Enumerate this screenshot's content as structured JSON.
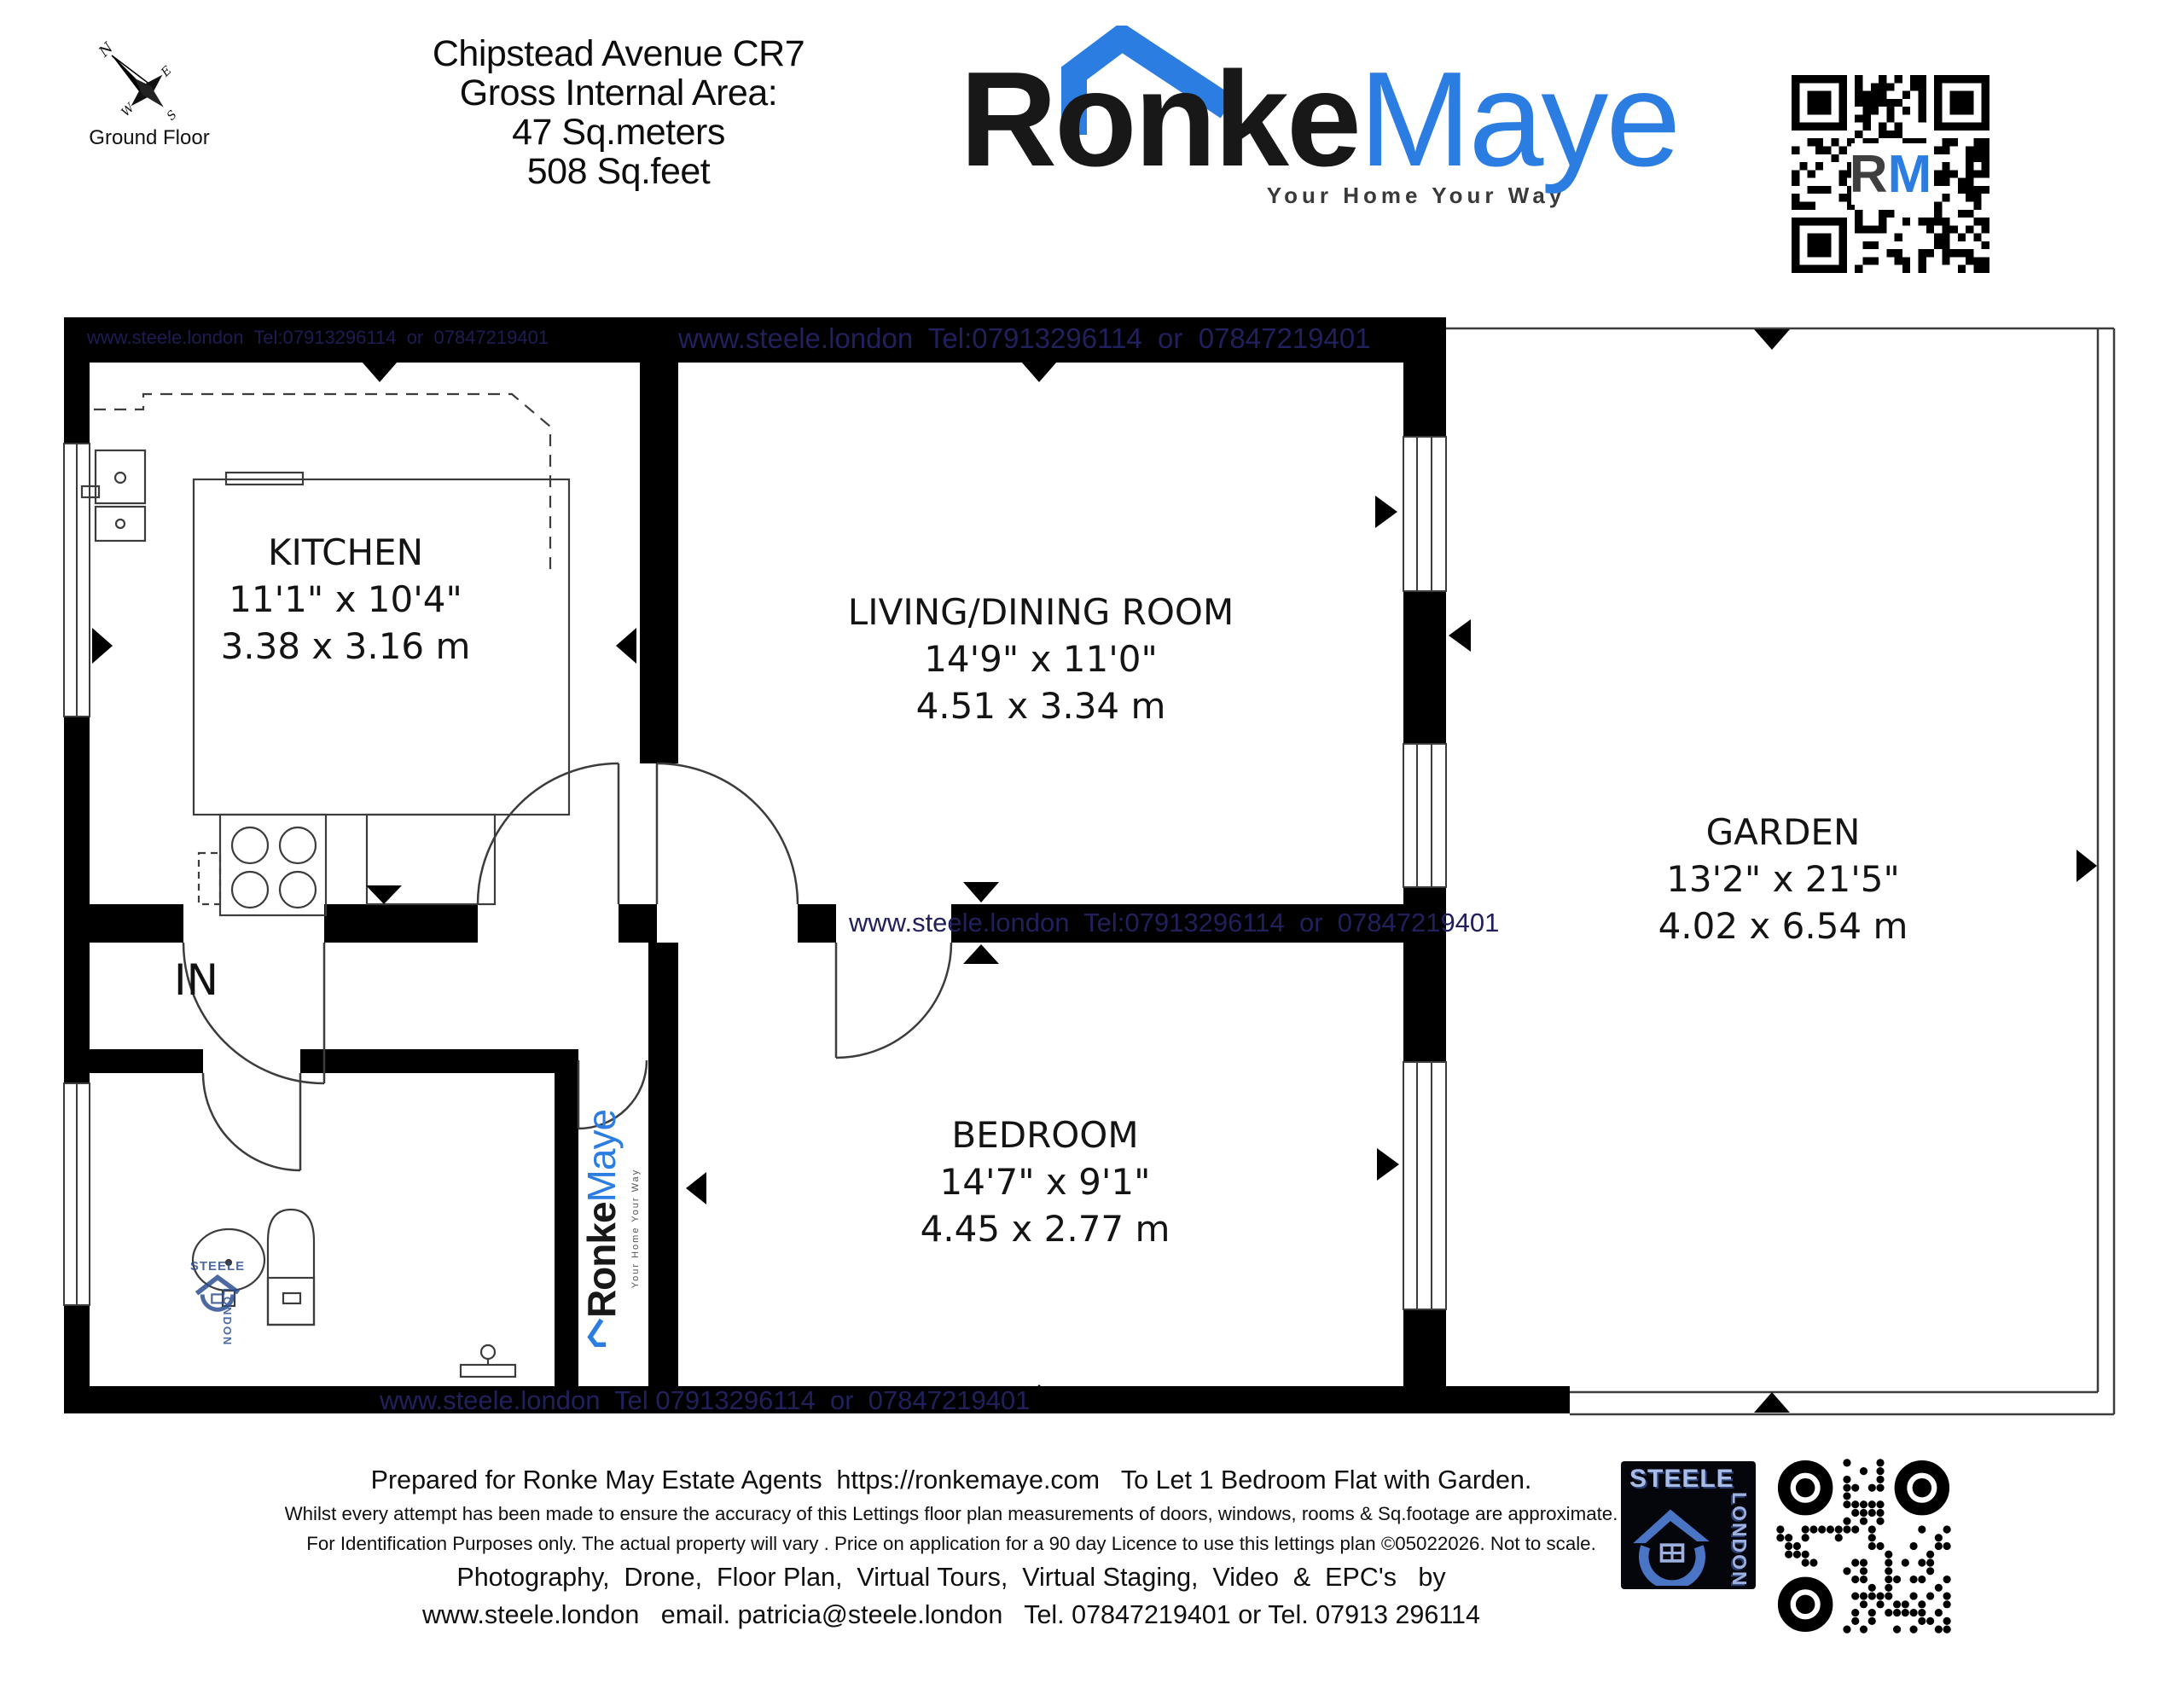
{
  "compass": {
    "north": "N",
    "east": "E",
    "south": "S",
    "west": "W"
  },
  "floor_label": "Ground Floor",
  "title_lines": [
    "Chipstead Avenue CR7",
    "Gross Internal Area:",
    "47 Sq.meters",
    "508 Sq.feet"
  ],
  "brand": {
    "word_dark": "Ronke",
    "word_blue": "Maye",
    "tagline": "Your Home Your Way",
    "qr_center_dark": "R",
    "qr_center_blue": "M",
    "blue": "#2b7de1",
    "dark": "#181818"
  },
  "watermark": {
    "text_top_small": "www.steele.london  Tel:07913296114  or  07847219401",
    "text_top_large": "www.steele.london  Tel:07913296114  or  07847219401",
    "text_middle": "www.steele.london  Tel:07913296114  or  07847219401",
    "text_bottom": "www.steele.london  Tel 07913296114  or  07847219401",
    "plan_logo_top": "STEELE",
    "plan_logo_side": "LONDON",
    "color": "#20205c"
  },
  "entrance_label": "IN",
  "rooms": [
    {
      "name": "KITCHEN",
      "imperial": "11'1\" x 10'4\"",
      "metric": "3.38 x 3.16 m"
    },
    {
      "name": "LIVING/DINING ROOM",
      "imperial": "14'9\" x 11'0\"",
      "metric": "4.51 x 3.34 m"
    },
    {
      "name": "BEDROOM",
      "imperial": "14'7\" x 9'1\"",
      "metric": "4.45 x 2.77 m"
    },
    {
      "name": "GARDEN",
      "imperial": "13'2\" x 21'5\"",
      "metric": "4.02 x 6.54 m"
    }
  ],
  "vertical_logo": {
    "word_dark": "Ronke",
    "word_blue": "Maye",
    "tagline": "Your Home Your Way"
  },
  "footer": {
    "line1": "Prepared for Ronke May Estate Agents  https://ronkemaye.com   To Let 1 Bedroom Flat with Garden.",
    "line2": "Whilst every attempt has been made to ensure the accuracy of this Lettings floor plan measurements of doors, windows, rooms & Sq.footage are approximate.",
    "line3": "For Identification Purposes only. The actual property will vary . Price on application for a 90 day Licence to use this lettings plan ©05022026. Not to scale.",
    "line4": "Photography,  Drone,  Floor Plan,  Virtual Tours,  Virtual Staging,  Video  &  EPC's   by",
    "line5": "www.steele.london   email. patricia@steele.london   Tel. 07847219401 or Tel. 07913 296114"
  },
  "steele_logo": {
    "top": "STEELE",
    "side": "LONDON"
  }
}
